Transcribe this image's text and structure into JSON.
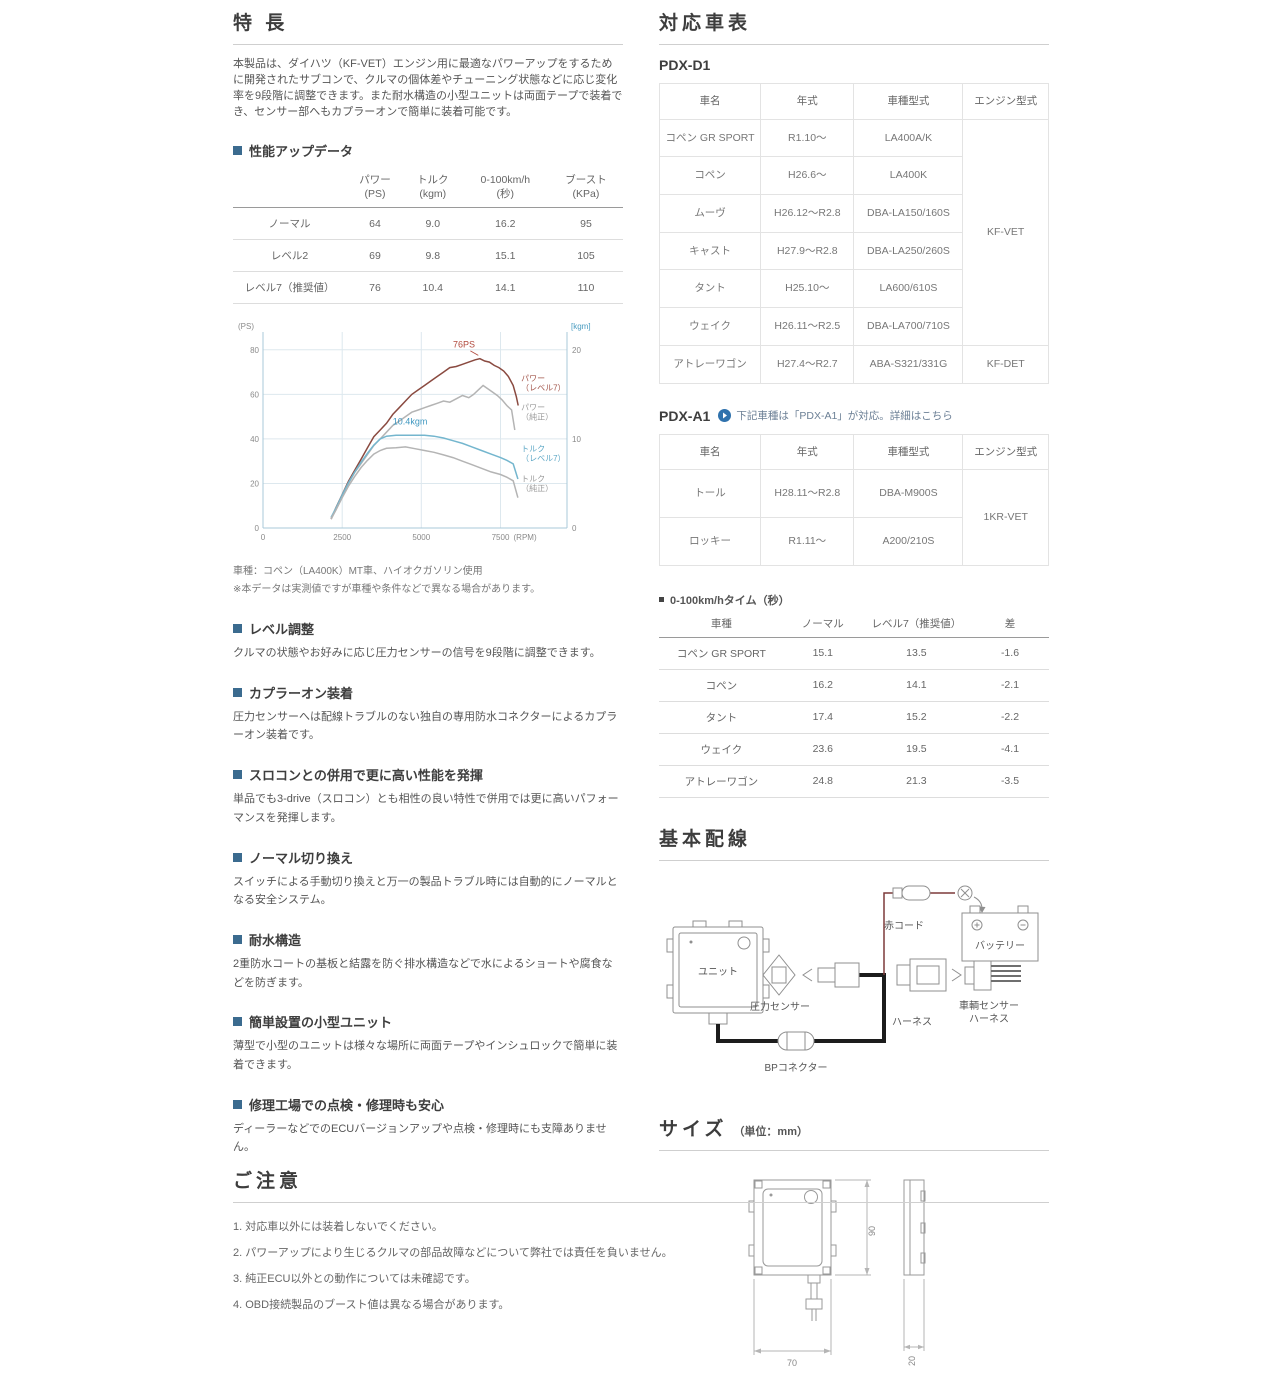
{
  "left": {
    "features_title": "特 長",
    "intro": "本製品は、ダイハツ（KF-VET）エンジン用に最適なパワーアップをするために開発されたサブコンで、クルマの個体差やチューニング状態などに応じ変化率を9段階に調整できます。また耐水構造の小型ユニットは両面テープで装着でき、センサー部へもカプラーオンで簡単に装着可能です。",
    "perf": {
      "title": "性能アップデータ",
      "col_headers": [
        {
          "l1": "パワー",
          "l2": "(PS)"
        },
        {
          "l1": "トルク",
          "l2": "(kgm)"
        },
        {
          "l1": "0-100km/h",
          "l2": "(秒)"
        },
        {
          "l1": "ブースト",
          "l2": "(KPa)"
        }
      ],
      "rows": [
        {
          "label": "ノーマル",
          "power": "64",
          "torque": "9.0",
          "accel": "16.2",
          "boost": "95"
        },
        {
          "label": "レベル2",
          "power": "69",
          "torque": "9.8",
          "accel": "15.1",
          "boost": "105"
        },
        {
          "label": "レベル7（推奨値）",
          "power": "76",
          "torque": "10.4",
          "accel": "14.1",
          "boost": "110"
        }
      ]
    },
    "chart_caption_1": "車種：コペン（LA400K）MT車、ハイオクガソリン使用",
    "chart_caption_2": "※本データは実測値ですが車種や条件などで異なる場合があります。",
    "sections": [
      {
        "title": "レベル調整",
        "body": "クルマの状態やお好みに応じ圧力センサーの信号を9段階に調整できます。"
      },
      {
        "title": "カプラーオン装着",
        "body": "圧力センサーへは配線トラブルのない独自の専用防水コネクターによるカプラーオン装着です。"
      },
      {
        "title": "スロコンとの併用で更に高い性能を発揮",
        "body": "単品でも3-drive（スロコン）とも相性の良い特性で併用では更に高いパフォーマンスを発揮します。"
      },
      {
        "title": "ノーマル切り換え",
        "body": "スイッチによる手動切り換えと万一の製品トラブル時には自動的にノーマルとなる安全システム。"
      },
      {
        "title": "耐水構造",
        "body": "2重防水コートの基板と結露を防ぐ排水構造などで水によるショートや腐食などを防ぎます。"
      },
      {
        "title": "簡単設置の小型ユニット",
        "body": "薄型で小型のユニットは様々な場所に両面テープやインシュロックで簡単に装着できます。"
      },
      {
        "title": "修理工場での点検・修理時も安心",
        "body": "ディーラーなどでのECUバージョンアップや点検・修理時にも支障ありません。"
      }
    ]
  },
  "right": {
    "compat_title": "対応車表",
    "pdxd1": {
      "label": "PDX-D1",
      "headers": [
        "車名",
        "年式",
        "車種型式",
        "エンジン型式"
      ],
      "rows": [
        {
          "name": "コペン GR SPORT",
          "year": "R1.10～",
          "model": "LA400A/K"
        },
        {
          "name": "コペン",
          "year": "H26.6～",
          "model": "LA400K"
        },
        {
          "name": "ムーヴ",
          "year": "H26.12～R2.8",
          "model": "DBA-LA150/160S"
        },
        {
          "name": "キャスト",
          "year": "H27.9～R2.8",
          "model": "DBA-LA250/260S"
        },
        {
          "name": "タント",
          "year": "H25.10～",
          "model": "LA600/610S"
        },
        {
          "name": "ウェイク",
          "year": "H26.11～R2.5",
          "model": "DBA-LA700/710S"
        },
        {
          "name": "アトレーワゴン",
          "year": "H27.4～R2.7",
          "model": "ABA-S321/331G"
        }
      ],
      "engine_main": "KF-VET",
      "engine_last": "KF-DET"
    },
    "pdxa1": {
      "label": "PDX-A1",
      "note": "下記車種は「PDX-A1」が対応。詳細はこちら",
      "headers": [
        "車名",
        "年式",
        "車種型式",
        "エンジン型式"
      ],
      "rows": [
        {
          "name": "トール",
          "year": "H28.11～R2.8",
          "model": "DBA-M900S"
        },
        {
          "name": "ロッキー",
          "year": "R1.11～",
          "model": "A200/210S"
        }
      ],
      "engine": "1KR-VET"
    },
    "accel": {
      "title": "0-100km/hタイム（秒）",
      "headers": [
        "車種",
        "ノーマル",
        "レベル7（推奨値）",
        "差"
      ],
      "rows": [
        [
          "コペン GR SPORT",
          "15.1",
          "13.5",
          "-1.6"
        ],
        [
          "コペン",
          "16.2",
          "14.1",
          "-2.1"
        ],
        [
          "タント",
          "17.4",
          "15.2",
          "-2.2"
        ],
        [
          "ウェイク",
          "23.6",
          "19.5",
          "-4.1"
        ],
        [
          "アトレーワゴン",
          "24.8",
          "21.3",
          "-3.5"
        ]
      ]
    },
    "wiring": {
      "title": "基本配線",
      "labels": {
        "unit": "ユニット",
        "pressure_sensor": "圧力センサー",
        "red_cord": "赤コード",
        "battery": "バッテリー",
        "vehicle_harness_1": "車輌センサー",
        "vehicle_harness_2": "ハーネス",
        "harness": "ハーネス",
        "bp_connector": "BPコネクター"
      }
    },
    "size": {
      "title": "サイズ",
      "unit": "（単位：mm）",
      "height": "90",
      "width": "70",
      "depth": "20"
    }
  },
  "notice": {
    "title": "ご注意",
    "items": [
      "1. 対応車以外には装着しないでください。",
      "2. パワーアップにより生じるクルマの部品故障などについて弊社では責任を負いません。",
      "3. 純正ECU以外との動作については未確認です。",
      "4. OBD接続製品のブースト値は異なる場合があります。"
    ]
  },
  "chart_data": {
    "type": "line",
    "xlabel": "(RPM)",
    "ylabel_left": "(PS)",
    "ylabel_right": "[kgm]",
    "xlim": [
      0,
      9600
    ],
    "x_ticks": [
      0,
      2500,
      5000,
      7500
    ],
    "ylim_left": [
      0,
      88
    ],
    "left_ticks": [
      0,
      20,
      40,
      60,
      80
    ],
    "ylim_right": [
      0,
      22
    ],
    "right_ticks": [
      0,
      10,
      20
    ],
    "grid_color": "#dde8ee",
    "axis_color": "#aac8d8",
    "annotations": [
      {
        "text": "76PS",
        "x": 6000,
        "y": 81,
        "color": "#b14a3e",
        "leader": [
          6550,
          79.5,
          6800,
          77.5
        ]
      },
      {
        "text": "10.4kgm",
        "x": 4100,
        "y": 46.5,
        "color": "#3e97c0"
      }
    ],
    "series": [
      {
        "name": "パワー（レベル7）",
        "axis": "left",
        "color": "#8a4a40",
        "label_lines": [
          "パワー",
          "（レベル7）"
        ],
        "label_x": 8150,
        "label_y": 66,
        "label_color": "#a2554a",
        "x": [
          2150,
          2300,
          2500,
          2700,
          2900,
          3100,
          3300,
          3500,
          3700,
          3900,
          4100,
          4300,
          4500,
          4700,
          4900,
          5100,
          5300,
          5500,
          5700,
          5900,
          6100,
          6300,
          6500,
          6700,
          6850,
          7000,
          7150,
          7300,
          7450,
          7600,
          7750,
          7900,
          8000,
          8060
        ],
        "y": [
          4,
          9,
          15,
          21,
          26,
          31,
          36,
          41,
          44,
          47,
          51,
          54,
          57,
          60,
          62,
          64,
          66,
          68,
          70,
          72,
          72.5,
          73.5,
          74.5,
          75.5,
          76,
          75,
          74.5,
          73,
          72,
          70.5,
          68,
          64,
          59,
          55
        ]
      },
      {
        "name": "パワー（純正）",
        "axis": "left",
        "color": "#b4b4b4",
        "label_lines": [
          "パワー",
          "（純正）"
        ],
        "label_x": 8150,
        "label_y": 53,
        "label_color": "#9a9a9a",
        "x": [
          2150,
          2300,
          2500,
          2700,
          2900,
          3100,
          3300,
          3500,
          3700,
          3900,
          4100,
          4300,
          4500,
          4700,
          4900,
          5100,
          5300,
          5500,
          5700,
          5900,
          6100,
          6300,
          6500,
          6650,
          6800,
          6950,
          7100,
          7250,
          7400,
          7550,
          7700,
          7850,
          7950
        ],
        "y": [
          4,
          8,
          14,
          20,
          25,
          29,
          33,
          37,
          40,
          43,
          46,
          48,
          50,
          52,
          53,
          54,
          55,
          56,
          57,
          56.5,
          58,
          59.5,
          58.5,
          60,
          62,
          64,
          62.5,
          61,
          59.5,
          57.5,
          55,
          53,
          44
        ]
      },
      {
        "name": "トルク（レベル7）",
        "axis": "right",
        "color": "#74b6ce",
        "label_lines": [
          "トルク",
          "（レベル7）"
        ],
        "label_x": 8150,
        "label_y": 8.6,
        "label_color": "#5fa8c6",
        "x": [
          2150,
          2300,
          2500,
          2700,
          2900,
          3100,
          3300,
          3500,
          3700,
          3900,
          4200,
          4500,
          4800,
          5100,
          5400,
          5700,
          6000,
          6300,
          6600,
          6900,
          7200,
          7500,
          7700,
          7900,
          8050
        ],
        "y": [
          1.2,
          2.2,
          3.7,
          5.1,
          6.3,
          7.4,
          8.4,
          9.3,
          10.0,
          10.3,
          10.4,
          10.4,
          10.4,
          10.4,
          10.3,
          10.1,
          9.8,
          9.5,
          9.1,
          8.7,
          8.3,
          7.9,
          7.6,
          7.2,
          5.5
        ]
      },
      {
        "name": "トルク（純正）",
        "axis": "right",
        "color": "#b4b4b4",
        "label_lines": [
          "トルク",
          "（純正）"
        ],
        "label_x": 8150,
        "label_y": 5.2,
        "label_color": "#9a9a9a",
        "x": [
          2150,
          2300,
          2500,
          2700,
          2900,
          3100,
          3300,
          3500,
          3700,
          3900,
          4200,
          4500,
          4800,
          5100,
          5400,
          5700,
          6000,
          6300,
          6600,
          6900,
          7200,
          7500,
          7700,
          7900,
          8050
        ],
        "y": [
          1.1,
          2.0,
          3.4,
          4.7,
          5.8,
          6.8,
          7.6,
          8.3,
          8.7,
          8.95,
          9.0,
          9.1,
          8.9,
          8.7,
          8.5,
          8.2,
          7.9,
          7.5,
          7.1,
          6.7,
          6.3,
          6.0,
          5.7,
          5.3,
          3.4
        ]
      }
    ]
  }
}
